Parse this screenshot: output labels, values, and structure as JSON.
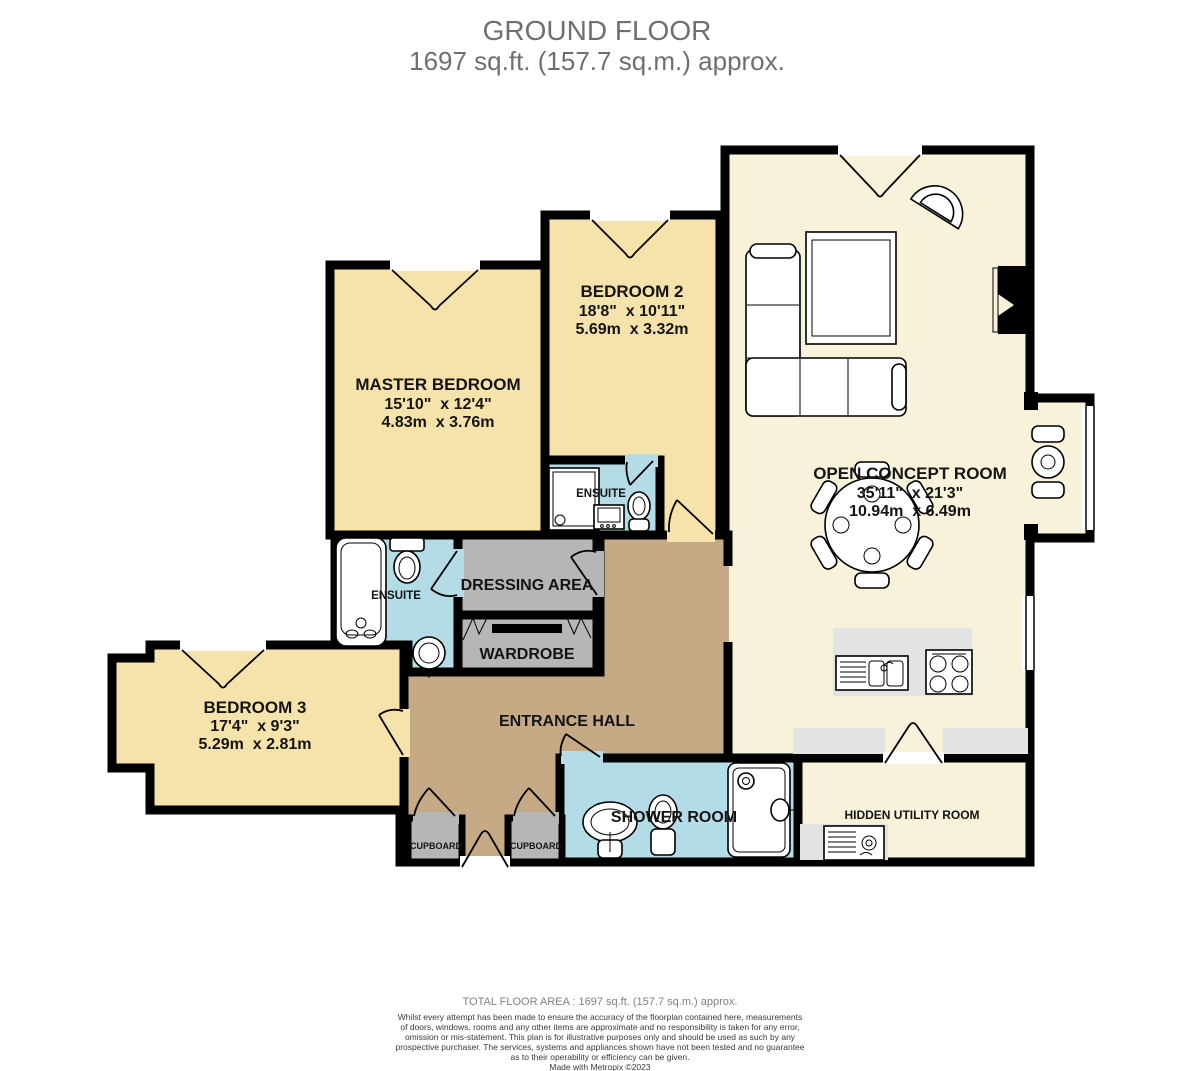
{
  "title": {
    "line1": "GROUND FLOOR",
    "line2": "1697 sq.ft. (157.7 sq.m.) approx."
  },
  "rooms": {
    "master_bedroom": {
      "name": "MASTER BEDROOM",
      "imperial": "15'10\"  x 12'4\"",
      "metric": "4.83m  x 3.76m"
    },
    "bedroom_2": {
      "name": "BEDROOM 2",
      "imperial": "18'8\"  x 10'11\"",
      "metric": "5.69m  x 3.32m"
    },
    "open_concept": {
      "name": "OPEN CONCEPT ROOM",
      "imperial": "35'11\"  x 21'3\"",
      "metric": "10.94m  x 6.49m"
    },
    "bedroom_3": {
      "name": "BEDROOM 3",
      "imperial": "17'4\"  x 9'3\"",
      "metric": "5.29m  x 2.81m"
    },
    "entrance_hall": {
      "name": "ENTRANCE HALL"
    },
    "dressing_area": {
      "name": "DRESSING AREA"
    },
    "wardrobe": {
      "name": "WARDROBE"
    },
    "ensuite_master": {
      "name": "ENSUITE"
    },
    "ensuite_bedroom2": {
      "name": "ENSUITE"
    },
    "shower_room": {
      "name": "SHOWER ROOM"
    },
    "hidden_utility": {
      "name": "HIDDEN UTILITY ROOM"
    },
    "cupboard_left": {
      "name": "CUPBOARD"
    },
    "cupboard_right": {
      "name": "CUPBOARD"
    }
  },
  "footer": {
    "total": "TOTAL FLOOR AREA : 1697 sq.ft. (157.7 sq.m.) approx.",
    "disclaimer_lines": [
      "Whilst every attempt has been made to ensure the accuracy of the floorplan contained here, measurements",
      "of doors, windows, rooms and any other items are approximate and no responsibility is taken for any error,",
      "omission or mis-statement. This plan is for illustrative purposes only and should be used as such by any",
      "prospective purchaser. The services, systems and appliances shown have not been tested and no guarantee",
      "as to their operability or efficiency can be given."
    ],
    "credit": "Made with Metropix ©2023"
  },
  "colors": {
    "bedroom": "#F6E3AC",
    "open": "#F8F2DA",
    "wet": "#B4DCE6",
    "storage": "#B6B6B6",
    "hall": "#C6AA85",
    "counter": "#E3E3E3",
    "wall": "#000000"
  }
}
